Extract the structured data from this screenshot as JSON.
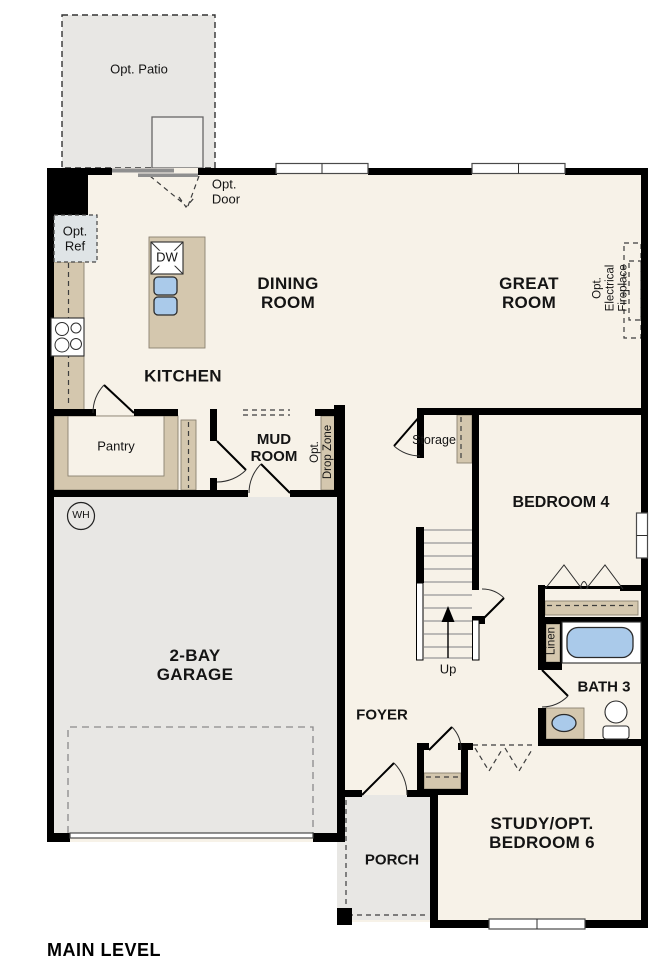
{
  "plan": {
    "title": "MAIN LEVEL",
    "rooms": {
      "dining": "DINING\nROOM",
      "great": "GREAT\nROOM",
      "kitchen": "KITCHEN",
      "mud": "MUD\nROOM",
      "bedroom4": "BEDROOM 4",
      "garage": "2-BAY\nGARAGE",
      "bath3": "BATH 3",
      "foyer": "FOYER",
      "porch": "PORCH",
      "study": "STUDY/OPT.\nBEDROOM 6"
    },
    "areas": {
      "opt_patio": "Opt. Patio",
      "pantry": "Pantry",
      "storage": "Storage",
      "linen": "Linen"
    },
    "annotations": {
      "opt_door": "Opt.\nDoor",
      "opt_ref": "Opt.\nRef",
      "opt_fireplace": "Opt. Electrical\nFireplace",
      "opt_dropzone": "Opt.\nDrop Zone",
      "up": "Up"
    },
    "fixtures": {
      "dishwasher": "DW",
      "water_heater": "WH"
    },
    "colors": {
      "floor": "#f7f2e8",
      "outdoor": "#e8e7e4",
      "cabinet": "#d4c7ae",
      "fixture": "#aacaea",
      "wall": "#000000"
    }
  }
}
